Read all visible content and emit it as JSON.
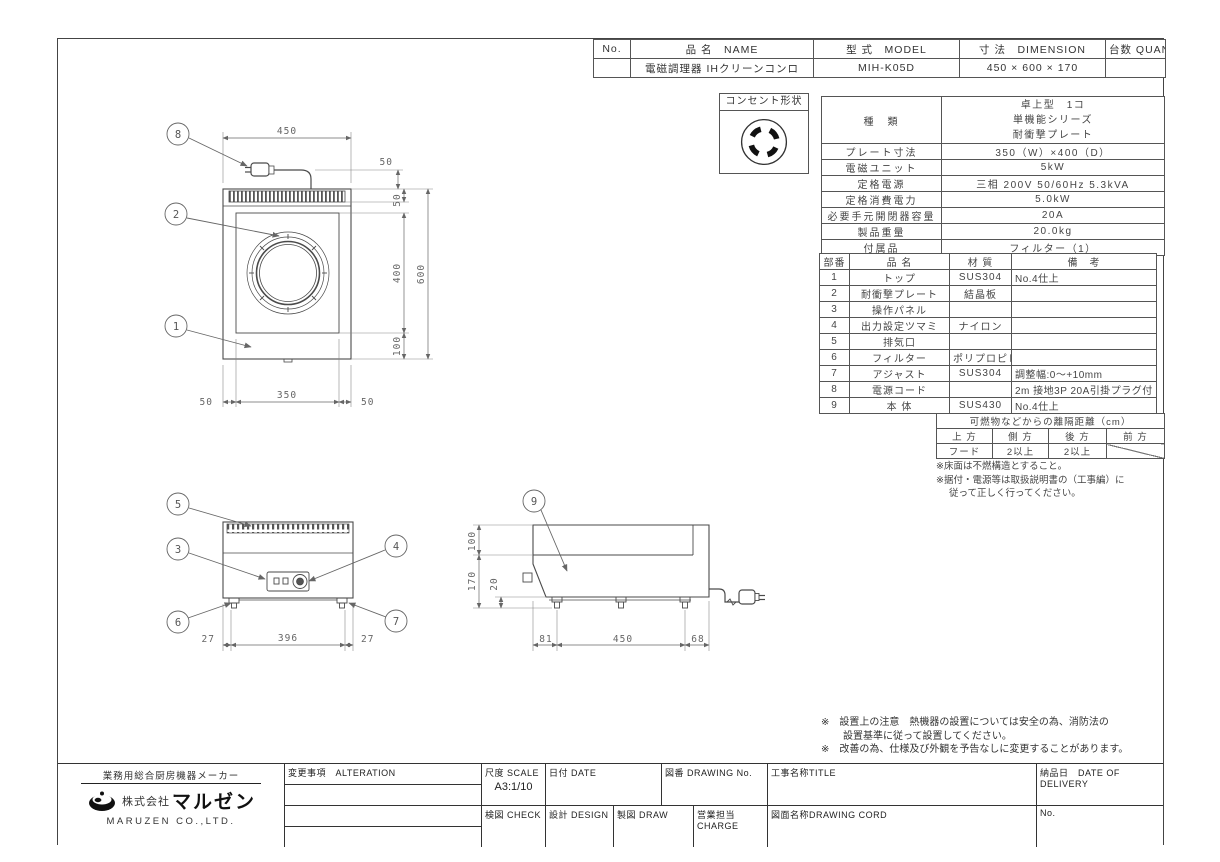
{
  "header_table": {
    "col_no": "No.",
    "col_name": "品 名　NAME",
    "col_model": "型 式　MODEL",
    "col_dimension": "寸 法　DIMENSION",
    "col_quantity": "台数 QUANTITY",
    "no": "",
    "name": "電磁調理器 IHクリーンコンロ",
    "model": "MIH-K05D",
    "dimension": "450 × 600 × 170",
    "quantity": ""
  },
  "outlet": {
    "title": "コンセント形状"
  },
  "spec": {
    "kind_label": "種　類",
    "kind_lines": [
      "卓上型　1コ",
      "単機能シリーズ",
      "耐衝撃プレート"
    ],
    "rows": [
      {
        "label": "プレート寸法",
        "value": "350（W）×400（D）"
      },
      {
        "label": "電磁ユニット",
        "value": "5kW"
      },
      {
        "label": "定格電源",
        "value": "三相 200V 50/60Hz 5.3kVA"
      },
      {
        "label": "定格消費電力",
        "value": "5.0kW"
      },
      {
        "label": "必要手元開閉器容量",
        "value": "20A"
      },
      {
        "label": "製品重量",
        "value": "20.0kg"
      },
      {
        "label": "付属品",
        "value": "フィルター（1）"
      }
    ]
  },
  "parts": {
    "headers": [
      "部番",
      "品 名",
      "材 質",
      "備　考"
    ],
    "rows": [
      [
        "1",
        "トップ",
        "SUS304",
        "No.4仕上"
      ],
      [
        "2",
        "耐衝撃プレート",
        "結晶板",
        ""
      ],
      [
        "3",
        "操作パネル",
        "",
        ""
      ],
      [
        "4",
        "出力設定ツマミ",
        "ナイロン",
        ""
      ],
      [
        "5",
        "排気口",
        "",
        ""
      ],
      [
        "6",
        "フィルター",
        "ポリプロピレン",
        ""
      ],
      [
        "7",
        "アジャスト",
        "SUS304",
        "調整幅:0〜+10mm"
      ],
      [
        "8",
        "電源コード",
        "",
        "2m 接地3P 20A引掛プラグ付"
      ],
      [
        "9",
        "本 体",
        "SUS430",
        "No.4仕上"
      ]
    ]
  },
  "clearance": {
    "title": "可燃物などからの離隔距離（cm）",
    "headers": [
      "上 方",
      "側 方",
      "後 方",
      "前 方"
    ],
    "values": [
      "フード",
      "2以上",
      "2以上",
      ""
    ],
    "notes": [
      "※床面は不燃構造とすること。",
      "※据付・電源等は取扱説明書の（工事編）に",
      "従って正しく行ってください。"
    ]
  },
  "footnotes": {
    "line1": "※　設置上の注意　熱機器の設置については安全の為、消防法の",
    "line2": "設置基準に従って設置してください。",
    "line3": "※　改善の為、仕様及び外観を予告なしに変更することがあります。"
  },
  "title_block": {
    "maker": "業務用総合厨房機器メーカー",
    "company_prefix": "株式会社",
    "company_name": "マルゼン",
    "company_en": "MARUZEN CO.,LTD.",
    "alteration": "変更事項　ALTERATION",
    "scale_label": "尺度 SCALE",
    "scale_value": "A3:1/10",
    "date_label": "日付 DATE",
    "drawing_no_label": "図番 DRAWING  No.",
    "title_label": "工事名称TITLE",
    "delivery_label": "納品日　DATE OF DELIVERY",
    "check_label": "検図 CHECK",
    "design_label": "設計 DESIGN",
    "draw_label": "製図 DRAW",
    "charge_label": "営業担当CHARGE",
    "drawing_cord_label": "図面名称DRAWING CORD",
    "no_label": "No."
  },
  "drawings": {
    "callouts": [
      "1",
      "2",
      "3",
      "4",
      "5",
      "6",
      "7",
      "8",
      "9"
    ],
    "plan": {
      "width": "450",
      "cord_gap": "50",
      "vent": "50",
      "plate_d": "400",
      "bottom": "100",
      "overall_d": "600",
      "left": "50",
      "plate_w": "350",
      "right": "50"
    },
    "front": {
      "left": "27",
      "span": "396",
      "right": "27"
    },
    "side": {
      "top": "100",
      "overall": "170",
      "foot": "20",
      "back": "81",
      "depth": "450",
      "front": "68"
    }
  }
}
